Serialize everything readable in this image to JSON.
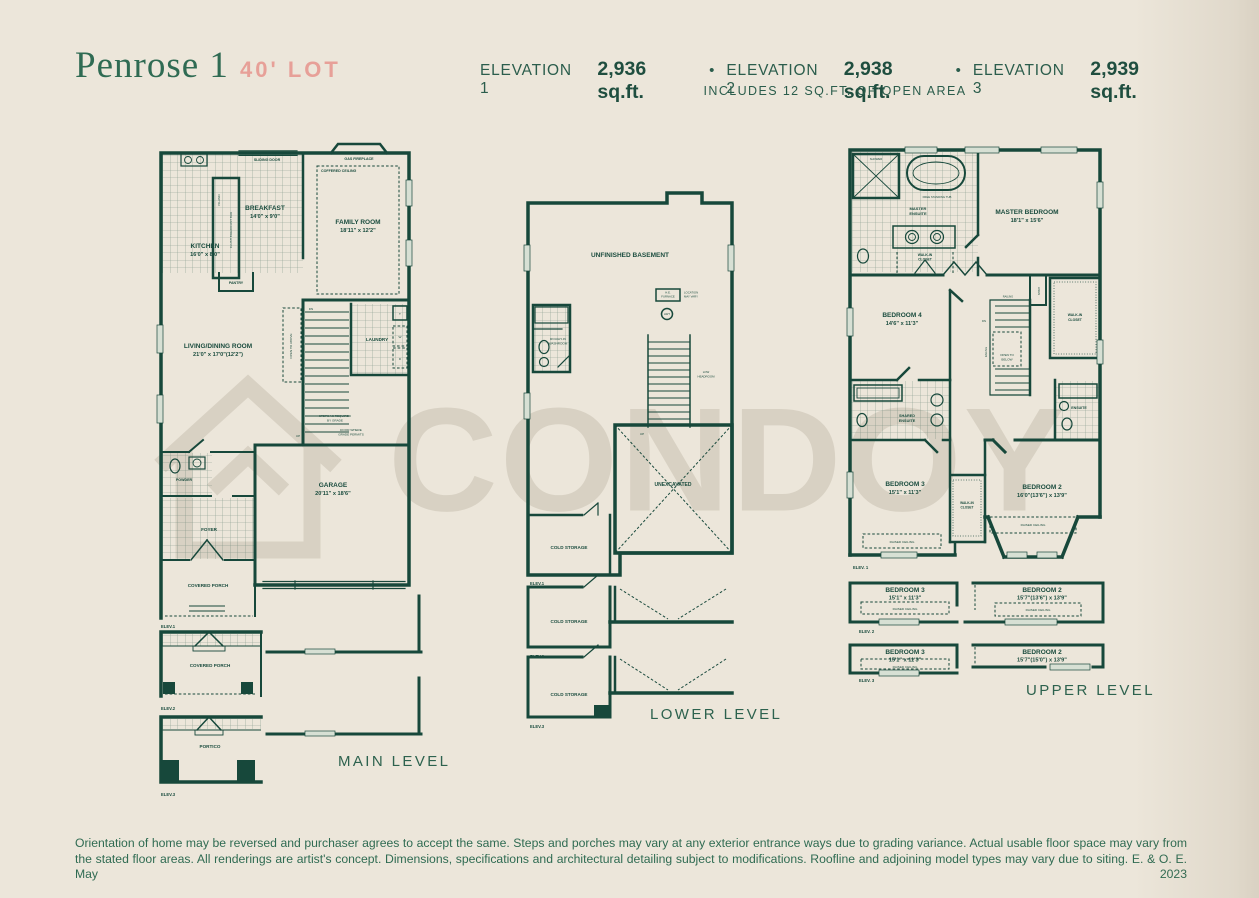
{
  "header": {
    "title": "Penrose 1",
    "lot": "40' LOT",
    "separator": "•",
    "elevations": [
      {
        "name": "ELEVATION 1",
        "area": "2,936 sq.ft."
      },
      {
        "name": "ELEVATION 2",
        "area": "2,938 sq.ft."
      },
      {
        "name": "ELEVATION 3",
        "area": "2,939 sq.ft."
      }
    ],
    "note": "INCLUDES 12 SQ.FT. OF OPEN AREA"
  },
  "watermark": {
    "text": "CONDOY"
  },
  "plans": {
    "main": {
      "caption": "MAIN LEVEL",
      "rooms": {
        "breakfast": {
          "name": "BREAKFAST",
          "dims": "14'0\" x 9'0\""
        },
        "family": {
          "name": "FAMILY ROOM",
          "dims": "18'11\" x 12'2\""
        },
        "kitchen": {
          "name": "KITCHEN",
          "dims": "16'0\" x 8'0\""
        },
        "living": {
          "name": "LIVING/DINING ROOM",
          "dims": "21'0\" x 17'0\"(12'2\")"
        },
        "garage": {
          "name": "GARAGE",
          "dims": "20'11\" x 18'6\""
        },
        "laundry": "LAUNDRY",
        "pantry": "PANTRY",
        "powder": "POWDER",
        "foyer": "FOYER",
        "covered_porch": "COVERED PORCH",
        "portico": "PORTICO"
      },
      "labels": {
        "sliding_door": "SLIDING DOOR",
        "gas_fireplace": "GAS FIREPLACE",
        "coffered_ceiling": "COFFERED CEILING",
        "island": "ISLAND",
        "flush_bar": "FLUSH BREAKFAST BAR",
        "dn": "DN",
        "up": "UP",
        "open_to_above": "OPEN TO ABOVE",
        "steps_note_lines": [
          "STEPS AS REQUIRED",
          "BY GRADE"
        ],
        "door_note_lines": [
          "DOOR WHERE",
          "GRADE PERMITS"
        ],
        "box_t": "T",
        "box_w": "W",
        "box_d": "D"
      },
      "elev_tags": [
        "ELEV.1",
        "ELEV.2",
        "ELEV.3"
      ]
    },
    "lower": {
      "caption": "LOWER LEVEL",
      "rooms": {
        "basement": "UNFINISHED BASEMENT",
        "unexcavated": "UNEXCAVATED",
        "cold_storage": "COLD STORAGE",
        "washroom_lines": [
          "ROUGH-IN",
          "WASHROOM"
        ]
      },
      "labels": {
        "furnace_lines": [
          "H.E.",
          "FURNACE"
        ],
        "location_lines": [
          "LOCATION",
          "MAY VARY"
        ],
        "hwt": "HWT",
        "low_headroom_lines": [
          "LOW",
          "HEADROOM"
        ],
        "up": "UP"
      },
      "elev_tags": [
        "ELEV.1",
        "ELEV.2",
        "ELEV.3"
      ]
    },
    "upper": {
      "caption": "UPPER LEVEL",
      "rooms": {
        "master": {
          "name": "MASTER BEDROOM",
          "dims": "18'1\" x 15'6\""
        },
        "bed4": {
          "name": "BEDROOM 4",
          "dims": "14'6\" x 11'3\""
        },
        "bed3": {
          "name": "BEDROOM 3",
          "dims": "15'1\" x 11'3\""
        },
        "bed2_e1": {
          "name": "BEDROOM 2",
          "dims": "16'0\"(13'6\") x 13'9\""
        },
        "bed2_e2": {
          "name": "BEDROOM 2",
          "dims": "15'7\"(13'6\") x 13'9\""
        },
        "bed2_e3": {
          "name": "BEDROOM 2",
          "dims": "15'7\"(15'0\") x 13'9\""
        },
        "master_ensuite_lines": [
          "MASTER",
          "ENSUITE"
        ],
        "shared_ensuite_lines": [
          "SHARED",
          "ENSUITE"
        ],
        "ensuite": "ENSUITE",
        "wic_lines": [
          "WALK-IN",
          "CLOSET"
        ]
      },
      "labels": {
        "shower": "SHOWER",
        "free_tub": "FREE STANDING TUB",
        "linen": "LINEN",
        "railing": "RAILING",
        "dn": "DN",
        "open_below_lines": [
          "OPEN TO",
          "BELOW"
        ],
        "raised_ceiling": "RAISED CEILING"
      },
      "elev_tags": [
        "ELEV. 1",
        "ELEV. 2",
        "ELEV. 3"
      ]
    }
  },
  "footer": {
    "disclaimer": "Orientation of home may be reversed and purchaser agrees to accept the same. Steps and porches may vary at any exterior entrance ways due to grading variance. Actual usable floor space may vary from the stated floor areas. All renderings are artist's concept. Dimensions, specifications and architectural detailing subject to modifications. Roofline and adjoining model types may vary due to siting. E. & O. E. May 2023"
  },
  "colors": {
    "ink": "#17483b",
    "accent_pink": "#e7a098",
    "background": "#ece6da",
    "watermark": "#d8d1c3"
  }
}
